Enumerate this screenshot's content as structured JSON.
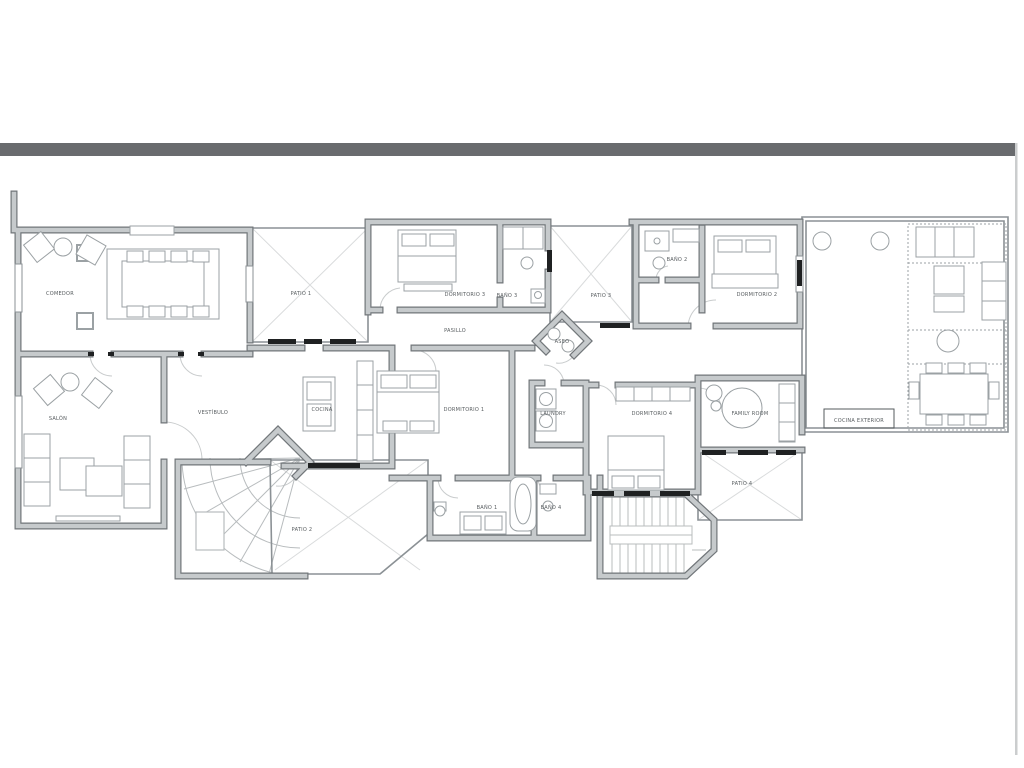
{
  "page": {
    "background": "#ffffff",
    "top_bar_color": "#696b6e",
    "frame_line_color": "#cbcdce"
  },
  "plan": {
    "wall_edge": "#71767a",
    "wall_fill": "#c6cacc",
    "thin_line": "#8b9195",
    "furniture_line": "#9ba1a4",
    "patio_cross": "#d9dbdc",
    "threshold": "#1f2122",
    "door_arc": "#c9cccd",
    "stair_line": "#b8bcbe",
    "label_color": "#565b5e"
  },
  "labels": {
    "comedor": "COMEDOR",
    "salon": "SALÓN",
    "vestibulo": "VESTÍBULO",
    "cocina": "COCINA",
    "pasillo": "PASILLO",
    "aseo": "ASEO",
    "patio1": "PATIO 1",
    "patio2": "PATIO 2",
    "patio3": "PATIO 3",
    "patio4": "PATIO 4",
    "dormitorio1": "DORMITORIO 1",
    "dormitorio2": "DORMITORIO 2",
    "dormitorio3": "DORMITORIO 3",
    "dormitorio4": "DORMITORIO 4",
    "bano1": "BAÑO 1",
    "bano2": "BAÑO 2",
    "bano3": "BAÑO 3",
    "bano4": "BAÑO 4",
    "laundry": "LAUNDRY",
    "family_room": "FAMILY ROOM",
    "cocina_exterior": "COCINA EXTERIOR"
  }
}
